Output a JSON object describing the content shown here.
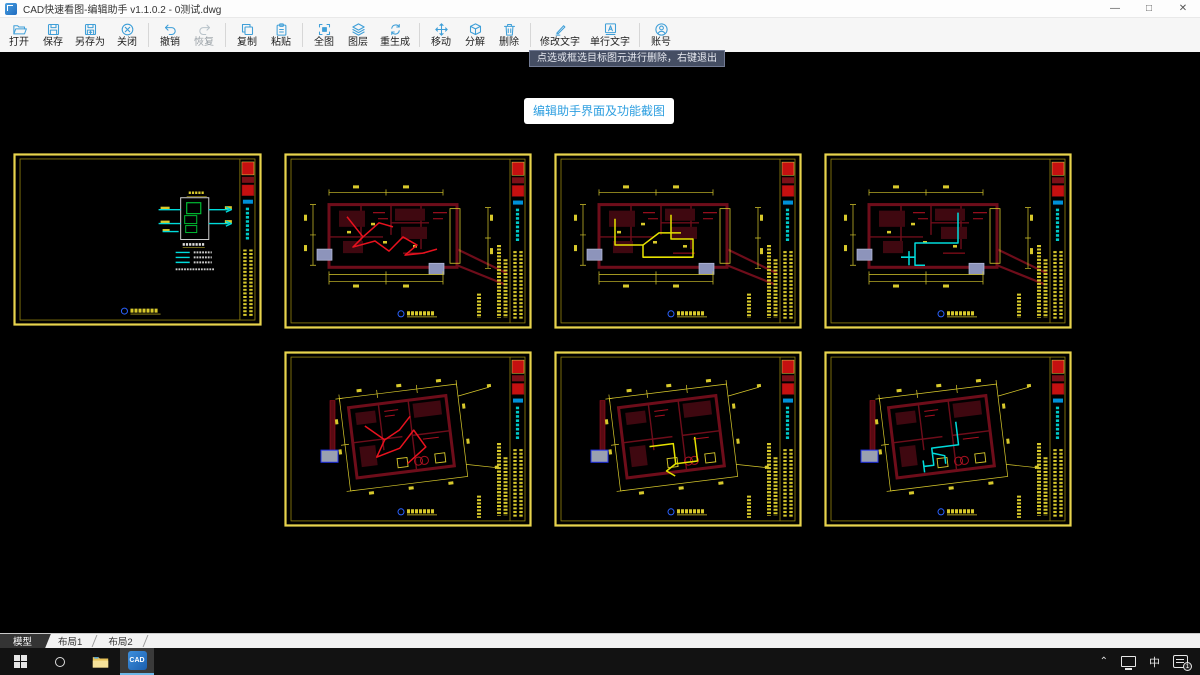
{
  "window": {
    "title": "CAD快速看图-编辑助手 v1.1.0.2 - 0测试.dwg"
  },
  "toolbar": {
    "buttons": [
      {
        "label": "打开",
        "icon": "open-folder-icon",
        "enabled": true
      },
      {
        "label": "保存",
        "icon": "save-icon",
        "enabled": true
      },
      {
        "label": "另存为",
        "icon": "save-as-icon",
        "enabled": true
      },
      {
        "label": "关闭",
        "icon": "close-circle-icon",
        "enabled": true
      },
      {
        "label": "撤销",
        "icon": "undo-icon",
        "enabled": true
      },
      {
        "label": "恢复",
        "icon": "redo-icon",
        "enabled": false
      },
      {
        "label": "复制",
        "icon": "copy-icon",
        "enabled": true
      },
      {
        "label": "粘贴",
        "icon": "paste-icon",
        "enabled": true
      },
      {
        "label": "全图",
        "icon": "fit-view-icon",
        "enabled": true
      },
      {
        "label": "图层",
        "icon": "layers-icon",
        "enabled": true
      },
      {
        "label": "重生成",
        "icon": "regenerate-icon",
        "enabled": true
      },
      {
        "label": "移动",
        "icon": "move-icon",
        "enabled": true
      },
      {
        "label": "分解",
        "icon": "explode-icon",
        "enabled": true
      },
      {
        "label": "删除",
        "icon": "delete-icon",
        "enabled": true
      },
      {
        "label": "修改文字",
        "icon": "edit-text-icon",
        "enabled": true
      },
      {
        "label": "单行文字",
        "icon": "single-line-text-icon",
        "enabled": true
      },
      {
        "label": "账号",
        "icon": "account-icon",
        "enabled": true
      }
    ]
  },
  "tooltip": {
    "text": "点选或框选目标图元进行删除，右键退出"
  },
  "overlay_button": {
    "label": "编辑助手界面及功能截图",
    "text_color": "#2e9fe0"
  },
  "thumbnails": [
    {
      "name": "sheet-1",
      "type": "schematic",
      "wiring": "#00dcdc"
    },
    {
      "name": "sheet-2",
      "type": "plan-flat",
      "wiring": "#e8121e"
    },
    {
      "name": "sheet-3",
      "type": "plan-flat",
      "wiring": "#e6e200"
    },
    {
      "name": "sheet-4",
      "type": "plan-flat",
      "wiring": "#00dcdc"
    },
    {
      "name": "sheet-5",
      "type": "plan-tilt",
      "wiring": "#e8121e"
    },
    {
      "name": "sheet-6",
      "type": "plan-tilt",
      "wiring": "#e6e200"
    },
    {
      "name": "sheet-7",
      "type": "plan-tilt",
      "wiring": "#00dcdc"
    }
  ],
  "sheet_tabs": [
    {
      "label": "模型",
      "active": true
    },
    {
      "label": "布局1",
      "active": false
    },
    {
      "label": "布局2",
      "active": false
    }
  ],
  "taskbar": {
    "ime_indicator": "中",
    "notification_badge": "1"
  },
  "colors": {
    "frame_yellow": "#e8d44d",
    "wall_dark_red": "#6e0d1a",
    "canvas_black": "#000000",
    "toolbar_icon_blue": "#3f9fd8"
  }
}
